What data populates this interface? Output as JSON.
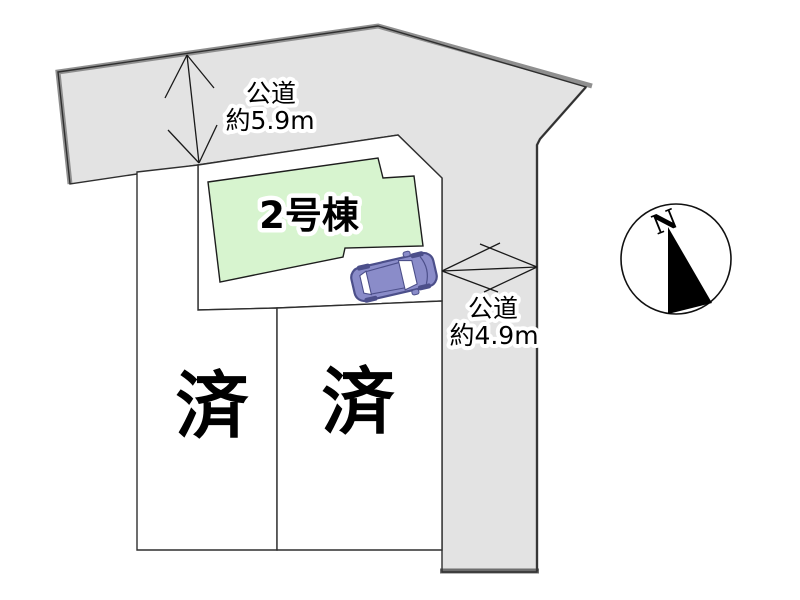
{
  "plot_plan": {
    "building": {
      "label": "2号棟"
    },
    "lots": [
      {
        "status": "済"
      },
      {
        "status": "済"
      }
    ],
    "roads": {
      "top": {
        "type": "公道",
        "width_label": "約5.9m"
      },
      "right": {
        "type": "公道",
        "width_label": "約4.9m"
      }
    },
    "compass": {
      "north": "N"
    },
    "colors": {
      "road_fill": "#e3e3e3",
      "road_outer_border": "#8f8f8f",
      "road_bottom_border": "#6e6e6e",
      "outline": "#2f2f2f",
      "lot_fill": "#ffffff",
      "building_fill": "#d7f4cf",
      "car_body": "#8a8cc9",
      "car_dark": "#4c4f8a",
      "needle": "#000000"
    }
  }
}
